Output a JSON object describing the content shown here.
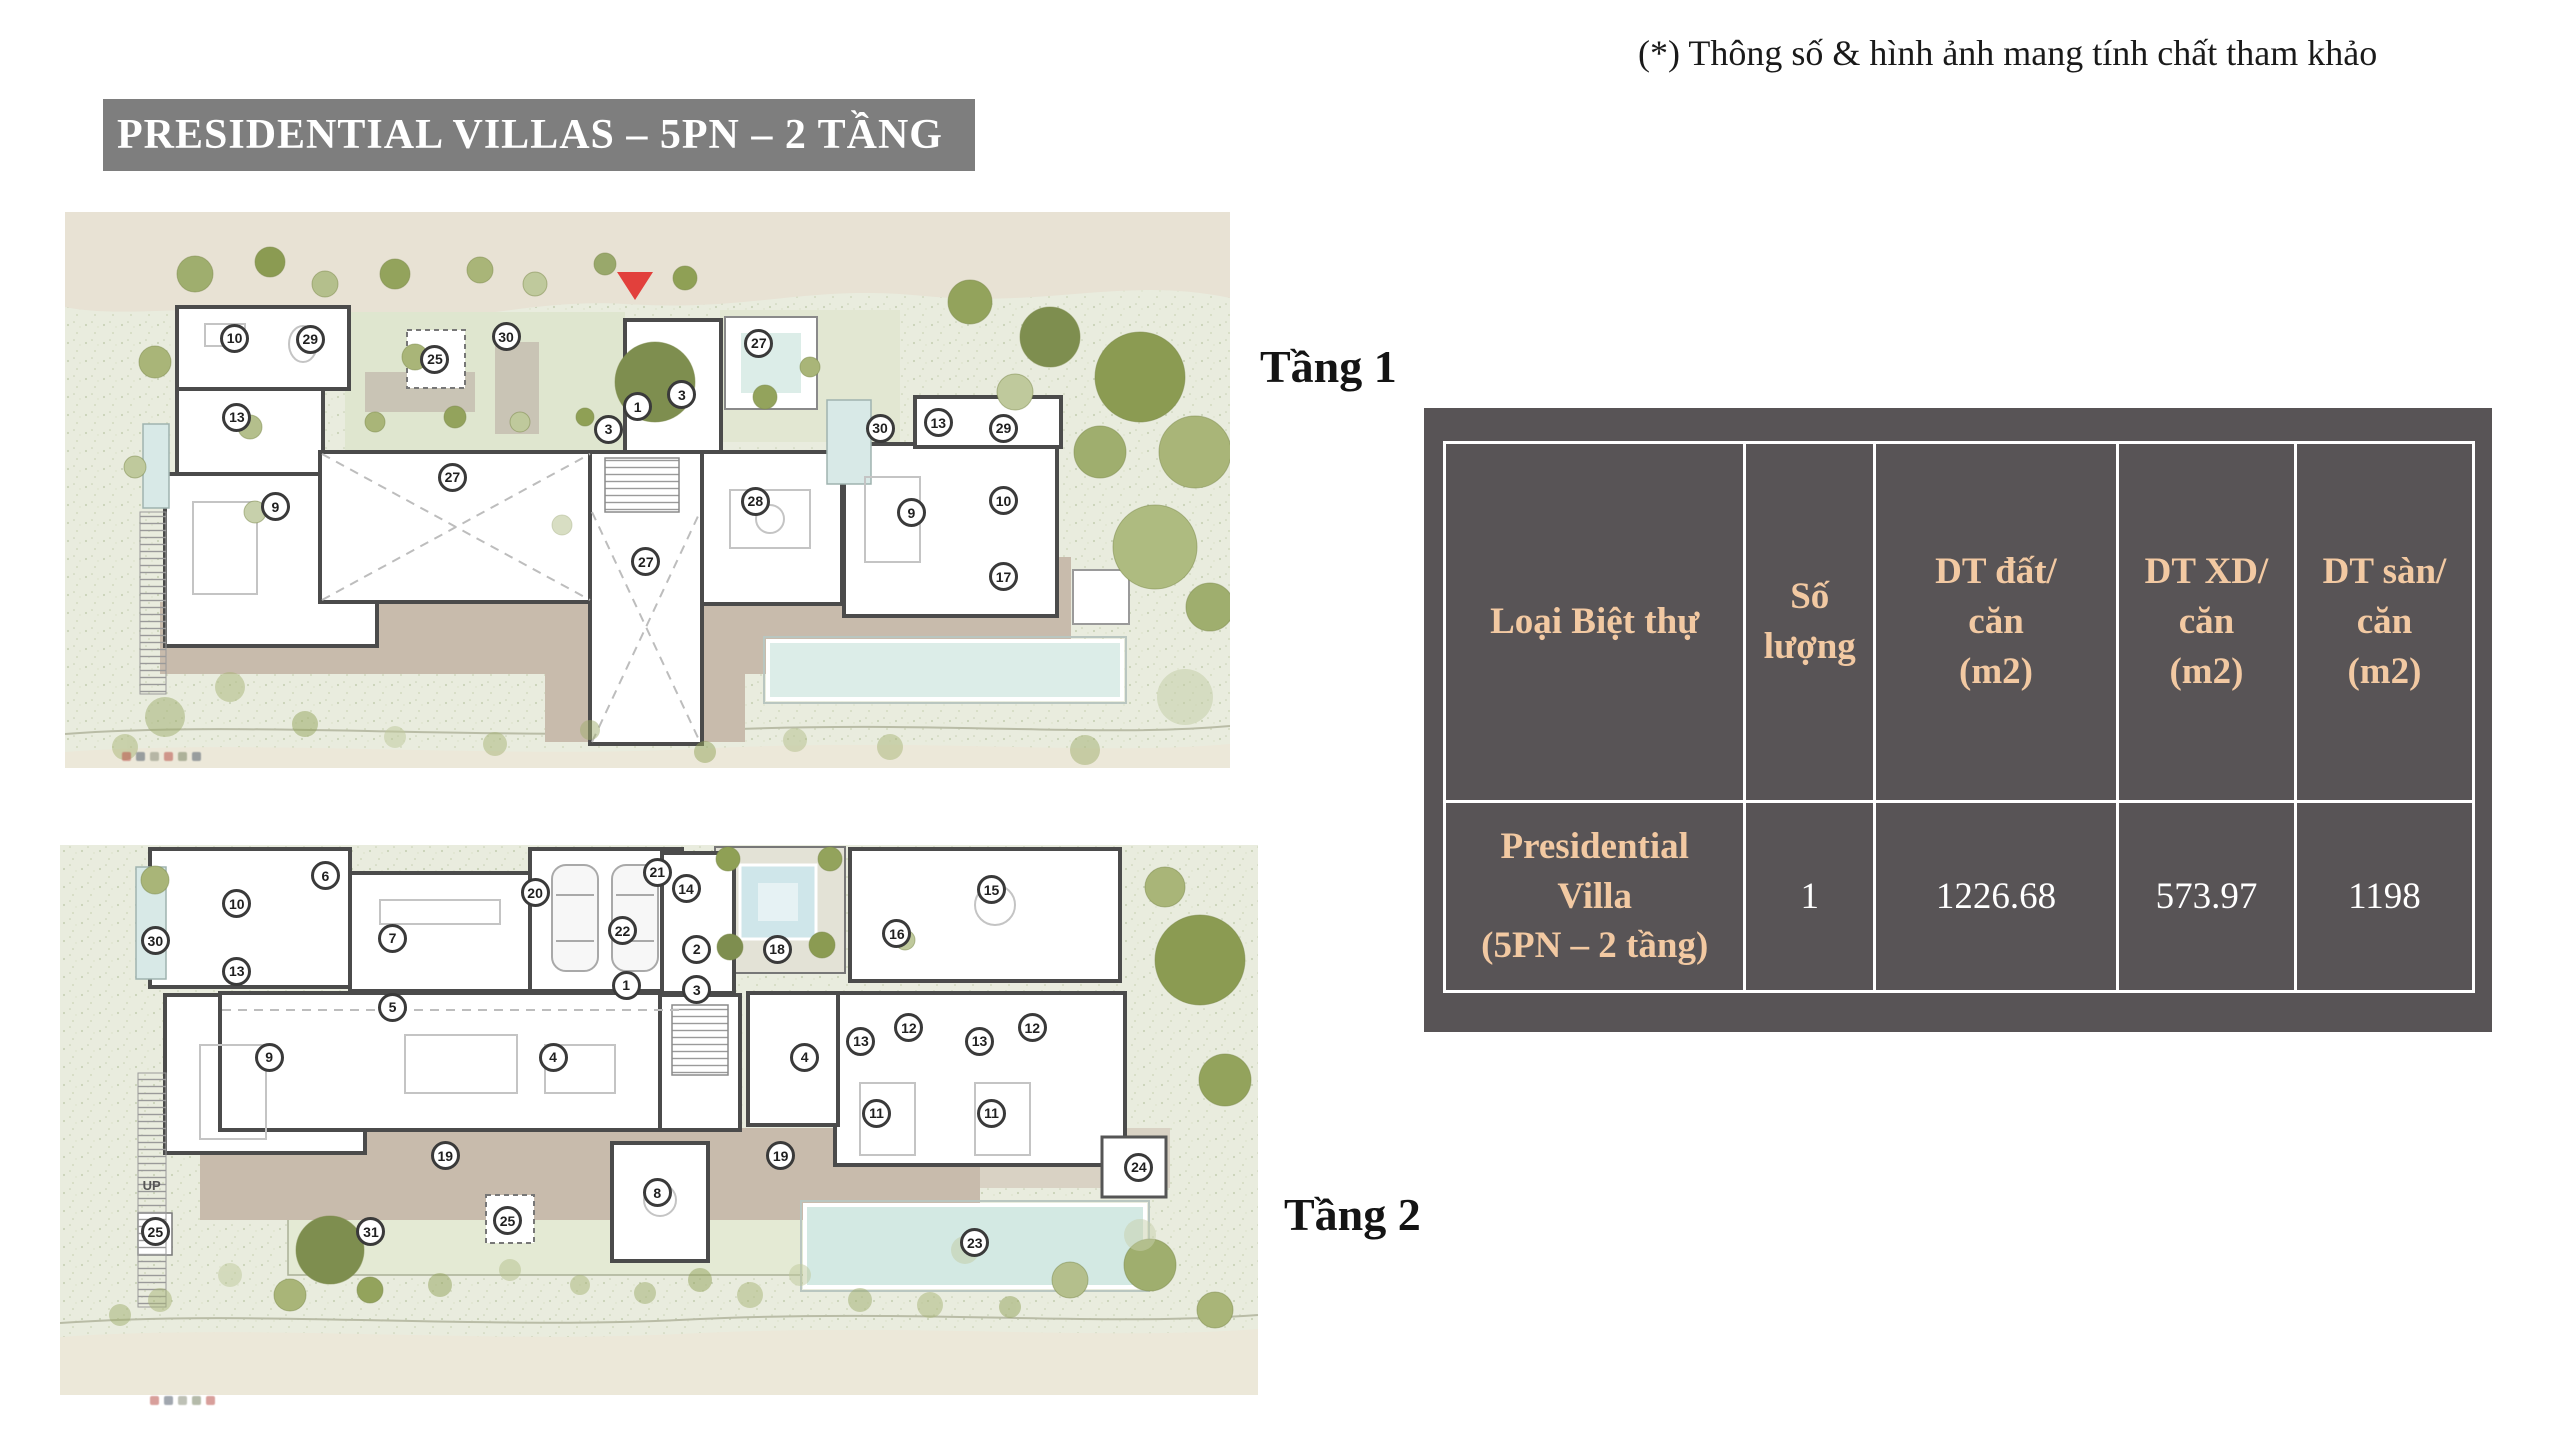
{
  "page": {
    "disclaimer": "(*) Thông số & hình ảnh mang tính chất tham khảo",
    "title": "PRESIDENTIAL VILLAS – 5PN – 2 TẦNG"
  },
  "floors": {
    "floor1_label": "Tầng 1",
    "floor2_label": "Tầng 2"
  },
  "table": {
    "headers": [
      "Loại Biệt thự",
      "Số\nlượng",
      "DT đất/\ncăn\n(m2)",
      "DT XD/\ncăn\n(m2)",
      "DT sàn/\ncăn\n(m2)"
    ],
    "row": {
      "type": "Presidential\nVilla\n(5PN – 2 tầng)",
      "quantity": "1",
      "land_area": "1226.68",
      "build_area": "573.97",
      "floor_area": "1198"
    }
  },
  "colors": {
    "banner_gray": "#7E7E7E",
    "table_background": "#585456",
    "table_header_text": "#F2C9A2",
    "table_value_text": "#FFFFFF",
    "entrance_marker_red": "#E2403C",
    "pool_blue": "#D9EBE7",
    "terrace_tan": "#C8BBAC",
    "landscape_green": "#E9ECDE"
  },
  "plans": {
    "plan1": {
      "markers": [
        {
          "n": "10",
          "x": 0.146,
          "y": 0.228
        },
        {
          "n": "29",
          "x": 0.211,
          "y": 0.23
        },
        {
          "n": "25",
          "x": 0.318,
          "y": 0.266
        },
        {
          "n": "30",
          "x": 0.379,
          "y": 0.225
        },
        {
          "n": "27",
          "x": 0.596,
          "y": 0.237
        },
        {
          "n": "13",
          "x": 0.148,
          "y": 0.37
        },
        {
          "n": "1",
          "x": 0.492,
          "y": 0.351
        },
        {
          "n": "3",
          "x": 0.53,
          "y": 0.33
        },
        {
          "n": "3",
          "x": 0.467,
          "y": 0.392
        },
        {
          "n": "30",
          "x": 0.7,
          "y": 0.39
        },
        {
          "n": "13",
          "x": 0.75,
          "y": 0.38
        },
        {
          "n": "29",
          "x": 0.806,
          "y": 0.39
        },
        {
          "n": "27",
          "x": 0.333,
          "y": 0.478
        },
        {
          "n": "9",
          "x": 0.181,
          "y": 0.531
        },
        {
          "n": "28",
          "x": 0.593,
          "y": 0.521
        },
        {
          "n": "9",
          "x": 0.727,
          "y": 0.542
        },
        {
          "n": "10",
          "x": 0.806,
          "y": 0.52
        },
        {
          "n": "27",
          "x": 0.499,
          "y": 0.63
        },
        {
          "n": "17",
          "x": 0.806,
          "y": 0.657
        }
      ]
    },
    "plan2": {
      "up_label": "UP",
      "markers": [
        {
          "n": "6",
          "x": 0.222,
          "y": 0.057
        },
        {
          "n": "10",
          "x": 0.148,
          "y": 0.108
        },
        {
          "n": "30",
          "x": 0.08,
          "y": 0.175
        },
        {
          "n": "13",
          "x": 0.148,
          "y": 0.23
        },
        {
          "n": "7",
          "x": 0.278,
          "y": 0.17
        },
        {
          "n": "20",
          "x": 0.397,
          "y": 0.088
        },
        {
          "n": "21",
          "x": 0.499,
          "y": 0.05
        },
        {
          "n": "14",
          "x": 0.523,
          "y": 0.08
        },
        {
          "n": "22",
          "x": 0.47,
          "y": 0.157
        },
        {
          "n": "2",
          "x": 0.532,
          "y": 0.19
        },
        {
          "n": "18",
          "x": 0.599,
          "y": 0.19
        },
        {
          "n": "16",
          "x": 0.699,
          "y": 0.162
        },
        {
          "n": "15",
          "x": 0.778,
          "y": 0.082
        },
        {
          "n": "1",
          "x": 0.473,
          "y": 0.256
        },
        {
          "n": "3",
          "x": 0.532,
          "y": 0.264
        },
        {
          "n": "5",
          "x": 0.278,
          "y": 0.296
        },
        {
          "n": "9",
          "x": 0.175,
          "y": 0.387
        },
        {
          "n": "4",
          "x": 0.412,
          "y": 0.387
        },
        {
          "n": "4",
          "x": 0.622,
          "y": 0.387
        },
        {
          "n": "13",
          "x": 0.669,
          "y": 0.358
        },
        {
          "n": "12",
          "x": 0.709,
          "y": 0.333
        },
        {
          "n": "13",
          "x": 0.768,
          "y": 0.358
        },
        {
          "n": "12",
          "x": 0.812,
          "y": 0.333
        },
        {
          "n": "11",
          "x": 0.682,
          "y": 0.489
        },
        {
          "n": "11",
          "x": 0.778,
          "y": 0.489
        },
        {
          "n": "19",
          "x": 0.322,
          "y": 0.566
        },
        {
          "n": "19",
          "x": 0.602,
          "y": 0.566
        },
        {
          "n": "8",
          "x": 0.499,
          "y": 0.633
        },
        {
          "n": "24",
          "x": 0.901,
          "y": 0.587
        },
        {
          "n": "25",
          "x": 0.374,
          "y": 0.684
        },
        {
          "n": "31",
          "x": 0.26,
          "y": 0.704
        },
        {
          "n": "25",
          "x": 0.08,
          "y": 0.704
        },
        {
          "n": "23",
          "x": 0.764,
          "y": 0.724
        }
      ]
    }
  }
}
